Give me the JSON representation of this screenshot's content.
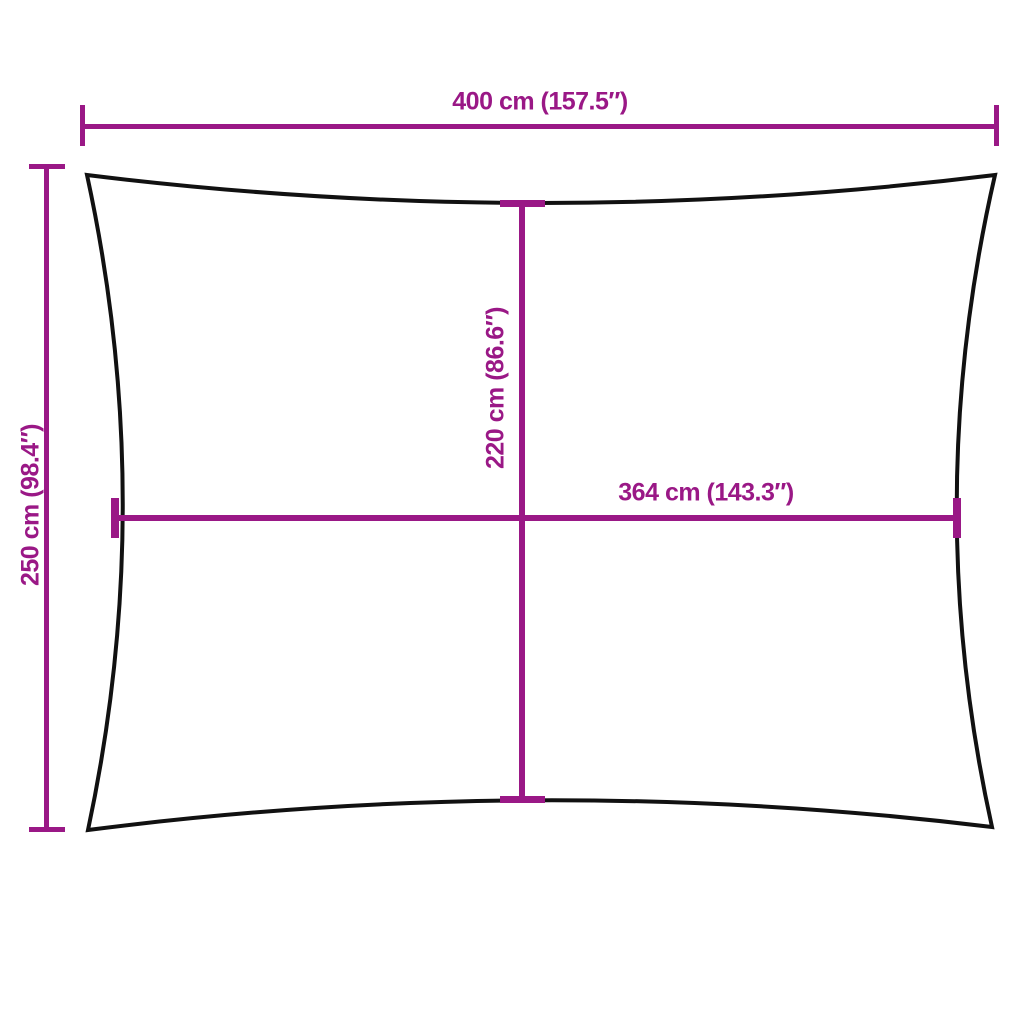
{
  "diagram": {
    "colors": {
      "dimension_lines": "#9A1886",
      "outline": "#111111",
      "background": "#FFFFFF"
    },
    "dimensions": {
      "top_width": {
        "label": "400 cm (157.5″)",
        "value_cm": 400,
        "value_in": 157.5,
        "orientation": "horizontal"
      },
      "left_height": {
        "label": "250 cm (98.4″)",
        "value_cm": 250,
        "value_in": 98.4,
        "orientation": "vertical"
      },
      "inner_height": {
        "label": "220 cm (86.6″)",
        "value_cm": 220,
        "value_in": 86.6,
        "orientation": "vertical"
      },
      "inner_width": {
        "label": "364 cm (143.3″)",
        "value_cm": 364,
        "value_in": 143.3,
        "orientation": "horizontal"
      }
    }
  }
}
